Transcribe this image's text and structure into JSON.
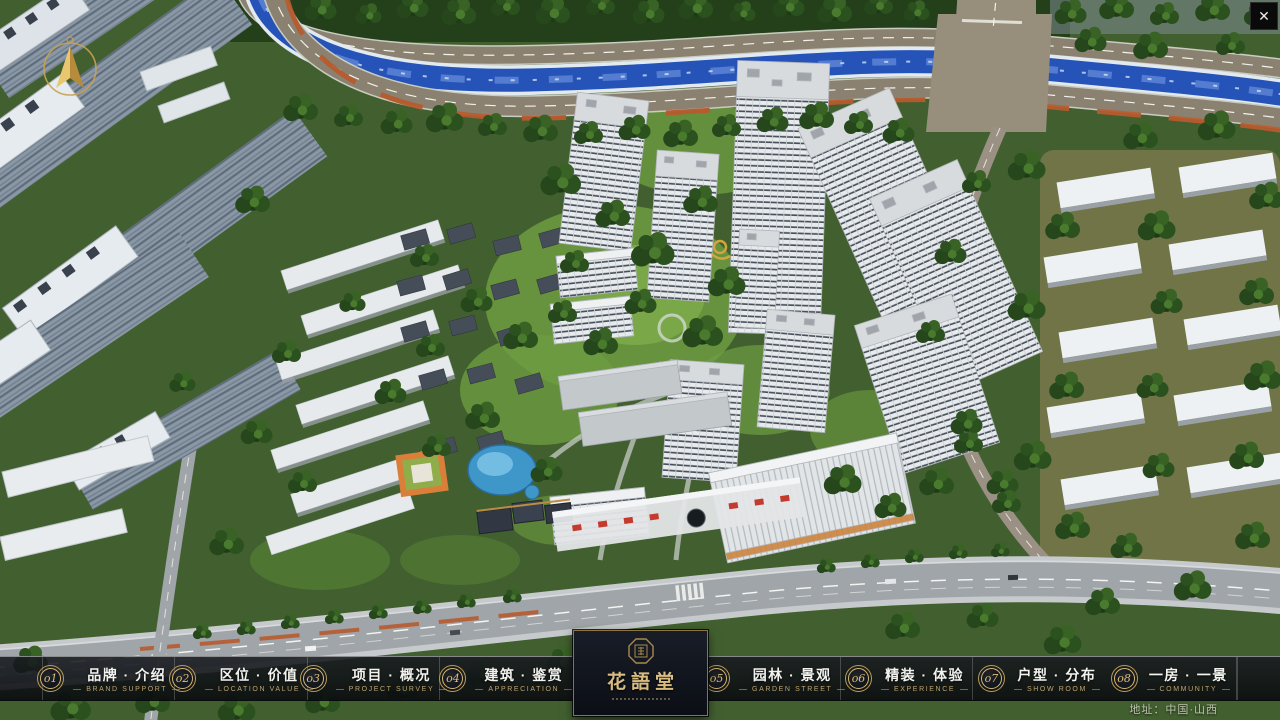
{
  "close": {
    "glyph": "✕"
  },
  "icons": {
    "close_icon": "x-glyph",
    "compass_icon": "gold-north-arrow-in-ring",
    "logo_seal_icon": "octagonal-seal"
  },
  "nav": {
    "items": [
      {
        "num": "o1",
        "zh": "品牌 · 介绍",
        "en": "BRAND SUPPORT"
      },
      {
        "num": "o2",
        "zh": "区位 · 价值",
        "en": "LOCATION VALUE"
      },
      {
        "num": "o3",
        "zh": "项目 · 概况",
        "en": "PROJECT SURVEY"
      },
      {
        "num": "o4",
        "zh": "建筑 · 鉴赏",
        "en": "APPRECIATION"
      },
      {
        "num": "o5",
        "zh": "园林 · 景观",
        "en": "GARDEN STREET"
      },
      {
        "num": "o6",
        "zh": "精装 · 体验",
        "en": "EXPERIENCE"
      },
      {
        "num": "o7",
        "zh": "户型 · 分布",
        "en": "SHOW ROOM"
      },
      {
        "num": "o8",
        "zh": "一房 · 一景",
        "en": "COMMUNITY"
      }
    ]
  },
  "logo": {
    "title": "花語堂"
  },
  "footer": {
    "address": "地址：中国·山西"
  },
  "colors": {
    "gold_accent": "#d6b878",
    "bar_bg": "#0c0e12",
    "river_blue": "#2553b8",
    "tree_green": "#2b511f",
    "road_gray": "#9fa5a8"
  }
}
